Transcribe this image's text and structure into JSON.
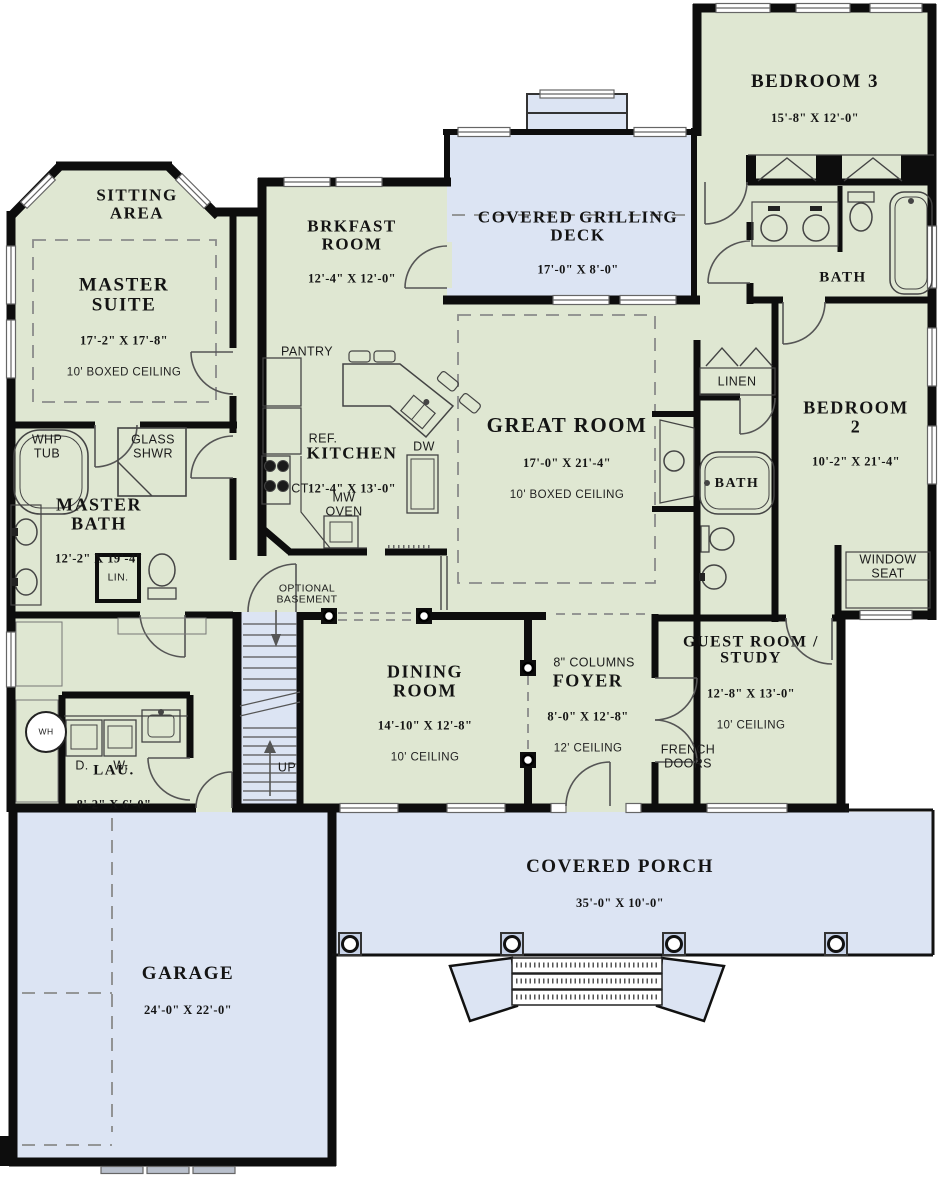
{
  "title": "First floor plan",
  "colors": {
    "interior": "#dfe7d2",
    "outdoor": "#dce4f3",
    "wall": "#0d0d0d",
    "line": "#555555",
    "dash": "#8a8a8a"
  },
  "rooms": {
    "sitting_area": {
      "name": "SITTING\nAREA"
    },
    "master_suite": {
      "name": "MASTER\nSUITE",
      "dims": "17'-2\" X 17'-8\"",
      "note": "10' BOXED CEILING"
    },
    "brkfast_room": {
      "name": "BRKFAST\nROOM",
      "dims": "12'-4\" X 12'-0\""
    },
    "grilling_deck": {
      "name": "COVERED GRILLING\nDECK",
      "dims": "17'-0\" X 8'-0\""
    },
    "bedroom3": {
      "name": "BEDROOM 3",
      "dims": "15'-8\" X 12'-0\""
    },
    "bath3": {
      "name": "BATH"
    },
    "kitchen": {
      "name": "KITCHEN",
      "dims": "12'-4\" X 13'-0\""
    },
    "great_room": {
      "name": "GREAT ROOM",
      "dims": "17'-0\" X 21'-4\"",
      "note": "10' BOXED CEILING"
    },
    "bedroom2": {
      "name": "BEDROOM 2",
      "dims": "10'-2\" X 21'-4\""
    },
    "bath2": {
      "name": "BATH"
    },
    "master_bath": {
      "name": "MASTER\nBATH",
      "dims": "12'-2\" X 19'-4\""
    },
    "dining_room": {
      "name": "DINING\nROOM",
      "dims": "14'-10\" X 12'-8\"",
      "note": "10' CEILING"
    },
    "foyer": {
      "name": "FOYER",
      "dims": "8'-0\" X 12'-8\"",
      "note": "12' CEILING"
    },
    "guest_room": {
      "name": "GUEST ROOM /\nSTUDY",
      "dims": "12'-8\" X 13'-0\"",
      "note": "10' CEILING"
    },
    "laundry": {
      "name": "LAU.",
      "dims": "8'-2\" X 6'-0\""
    },
    "covered_porch": {
      "name": "COVERED PORCH",
      "dims": "35'-0\" X 10'-0\""
    },
    "garage": {
      "name": "GARAGE",
      "dims": "24'-0\" X 22'-0\""
    }
  },
  "annotations": {
    "pantry": "PANTRY",
    "refrigerator": "REF.",
    "cooktop": "CT",
    "microwave": "MW\nOVEN",
    "dishwasher": "DW",
    "whirlpool_tub": "WHP\nTUB",
    "glass_shower": "GLASS\nSHWR",
    "linen_small": "LIN.",
    "linen": "LINEN",
    "window_seat": "WINDOW\nSEAT",
    "optional_basement": "OPTIONAL\nBASEMENT",
    "columns": "8\" COLUMNS",
    "french_doors": "FRENCH\nDOORS",
    "up": "UP",
    "dryer": "D.",
    "washer": "W.",
    "water_heater": "WH"
  }
}
